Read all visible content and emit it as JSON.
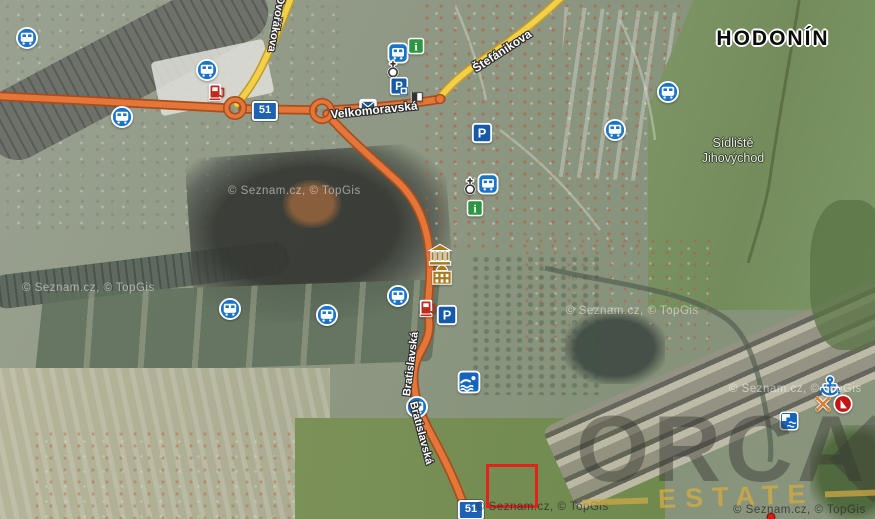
{
  "map": {
    "city_label": "HODONÍN",
    "district_line1": "Sídliště",
    "district_line2": "Jihovýchod",
    "copyright_text": "© Seznam.cz, © TopGis",
    "brand": "ORCA",
    "brand_sub": "ESTATE"
  },
  "colors": {
    "road_primary": "#e4763a",
    "road_primary_border": "#a84e1e",
    "road_secondary": "#f2d14a",
    "road_secondary_border": "#c49a28",
    "poi_blue": "#1a74c8",
    "poi_green": "#2e9640",
    "badge_blue": "#1e62b4",
    "selection_red": "#e3231a",
    "brand_gold": "#cda84a"
  },
  "streets": [
    {
      "name": "Dvořákova",
      "x": 276,
      "y": 24,
      "angle": 100,
      "size": 11
    },
    {
      "name": "Velkomoravská",
      "x": 374,
      "y": 110,
      "angle": -6,
      "size": 12
    },
    {
      "name": "Štefánikova",
      "x": 502,
      "y": 51,
      "angle": -33,
      "size": 12
    },
    {
      "name": "Bratislavská",
      "x": 411,
      "y": 364,
      "angle": -83,
      "size": 11
    },
    {
      "name": "Bratislavská",
      "x": 421,
      "y": 433,
      "angle": 75,
      "size": 11
    }
  ],
  "road_badges": [
    {
      "label": "51",
      "x": 265,
      "y": 111
    },
    {
      "label": "51",
      "x": 471,
      "y": 510
    }
  ],
  "watermarks": [
    {
      "x": 228,
      "y": 185,
      "variant": "light"
    },
    {
      "x": 22,
      "y": 282,
      "variant": "light"
    },
    {
      "x": 566,
      "y": 305,
      "variant": "light"
    },
    {
      "x": 729,
      "y": 383,
      "variant": "light"
    },
    {
      "x": 476,
      "y": 501,
      "variant": "dark"
    },
    {
      "x": 733,
      "y": 504,
      "variant": "dark"
    }
  ],
  "markers": [
    {
      "type": "bus",
      "x": 27,
      "y": 38
    },
    {
      "type": "bus",
      "x": 207,
      "y": 70
    },
    {
      "type": "bus",
      "x": 122,
      "y": 117
    },
    {
      "type": "fuel",
      "x": 217,
      "y": 92
    },
    {
      "type": "bus-square",
      "x": 398,
      "y": 53
    },
    {
      "type": "info",
      "x": 416,
      "y": 46
    },
    {
      "type": "church",
      "x": 393,
      "y": 70
    },
    {
      "type": "parking-meter",
      "x": 399,
      "y": 86
    },
    {
      "type": "flag",
      "x": 416,
      "y": 99
    },
    {
      "type": "post",
      "x": 368,
      "y": 106
    },
    {
      "type": "parking",
      "x": 482,
      "y": 133
    },
    {
      "type": "bus-square",
      "x": 488,
      "y": 184
    },
    {
      "type": "church",
      "x": 470,
      "y": 187
    },
    {
      "type": "info",
      "x": 475,
      "y": 208
    },
    {
      "type": "museum",
      "x": 440,
      "y": 255
    },
    {
      "type": "palace",
      "x": 442,
      "y": 275
    },
    {
      "type": "bus",
      "x": 230,
      "y": 309
    },
    {
      "type": "bus",
      "x": 327,
      "y": 315
    },
    {
      "type": "bus",
      "x": 398,
      "y": 296
    },
    {
      "type": "fuel",
      "x": 428,
      "y": 308
    },
    {
      "type": "parking",
      "x": 447,
      "y": 315
    },
    {
      "type": "swim",
      "x": 469,
      "y": 382
    },
    {
      "type": "bus",
      "x": 417,
      "y": 407
    },
    {
      "type": "bus",
      "x": 668,
      "y": 92
    },
    {
      "type": "bus",
      "x": 615,
      "y": 130
    },
    {
      "type": "anchor",
      "x": 830,
      "y": 387
    },
    {
      "type": "paddles",
      "x": 823,
      "y": 404
    },
    {
      "type": "sail",
      "x": 843,
      "y": 404
    },
    {
      "type": "weir",
      "x": 789,
      "y": 421
    },
    {
      "type": "marker-dot",
      "x": 771,
      "y": 517
    }
  ],
  "selection": {
    "x": 486,
    "y": 464,
    "width": 46,
    "height": 38
  }
}
